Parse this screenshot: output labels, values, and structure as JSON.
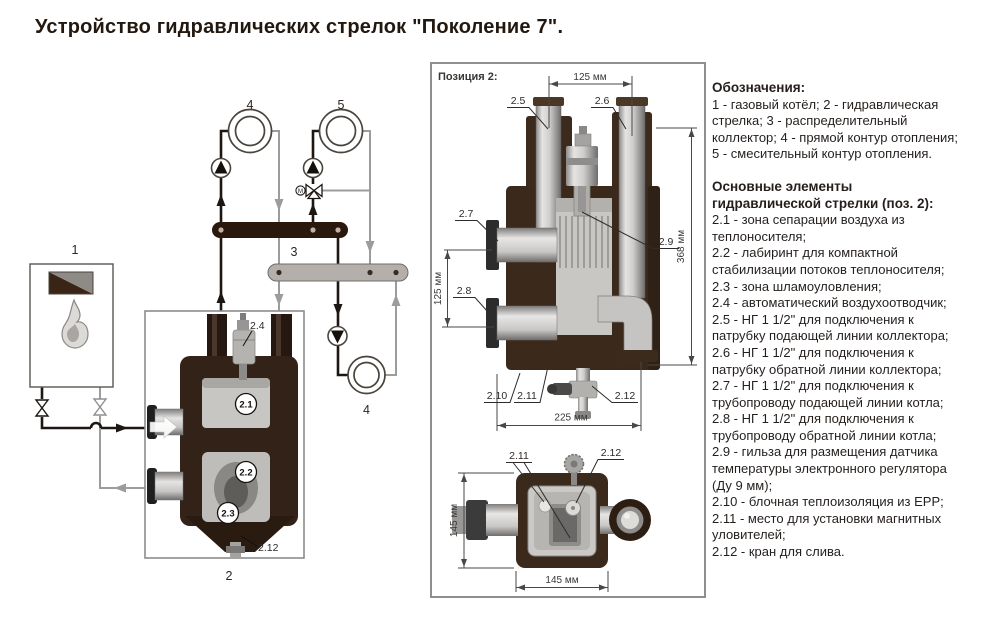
{
  "title": "Устройство гидравлических стрелок \"Поколение 7\".",
  "schematic": {
    "label_boiler": "1",
    "label_separator": "2",
    "label_collector": "3",
    "label_direct_circuit_top": "4",
    "label_direct_circuit_bottom": "4",
    "label_mixing_circuit": "5",
    "motor_m": "М",
    "callout_21": "2.1",
    "callout_22": "2.2",
    "callout_23": "2.3",
    "callout_24": "2.4",
    "callout_212": "2.12"
  },
  "panel": {
    "title": "Позиция 2:",
    "front": {
      "c25": "2.5",
      "c26": "2.6",
      "c27": "2.7",
      "c28": "2.8",
      "c29": "2.9",
      "c210": "2.10",
      "c211": "2.11",
      "c212": "2.12",
      "dim_top": "125 мм",
      "dim_right": "368 мм",
      "dim_left": "125 мм",
      "dim_bottom": "225 мм"
    },
    "bottom": {
      "c211": "2.11",
      "c212": "2.12",
      "dim_left": "145 мм",
      "dim_bottom": "145 мм"
    }
  },
  "legend": {
    "heading1": "Обозначения:",
    "para1": "1 - газовый котёл; 2 - гидравлическая стрелка; 3 - распределительный коллектор; 4 - прямой контур отопления; 5 - смесительный контур отопления.",
    "heading2": "Основные элементы гидравлической стрелки (поз. 2):",
    "items": [
      "2.1 - зона сепарации воздуха из теплоносителя;",
      "2.2 - лабиринт для компактной стабилизации потоков теплоносителя;",
      "2.3 - зона шламоуловления;",
      "2.4 - автоматический воздухоотводчик;",
      "2.5 - НГ 1 1/2\" для подключения к патрубку подающей линии коллектора;",
      "2.6 - НГ 1 1/2\" для подключения к патрубку обратной линии коллектора;",
      "2.7 - НГ 1 1/2\" для подключения к трубопроводу подающей линии котла;",
      "2.8 - НГ 1 1/2\" для подключения к трубопроводу обратной линии котла;",
      "2.9 - гильза для размещения датчика температуры электронного регулятора (Ду 9 мм);",
      "2.10 - блочная теплоизоляция из EPP;",
      "2.11 - место для установки магнитных уловителей;",
      "2.12 - кран для слива."
    ]
  },
  "colors": {
    "supply_line_black": "#1c1713",
    "return_line_gray": "#9c9c9c",
    "supply_manifold_brown": "#2a180d",
    "collector_gray": "#b4afaa",
    "insulation_brown": "#3b2a1b",
    "panel_border_gray": "#8f8f8f"
  }
}
